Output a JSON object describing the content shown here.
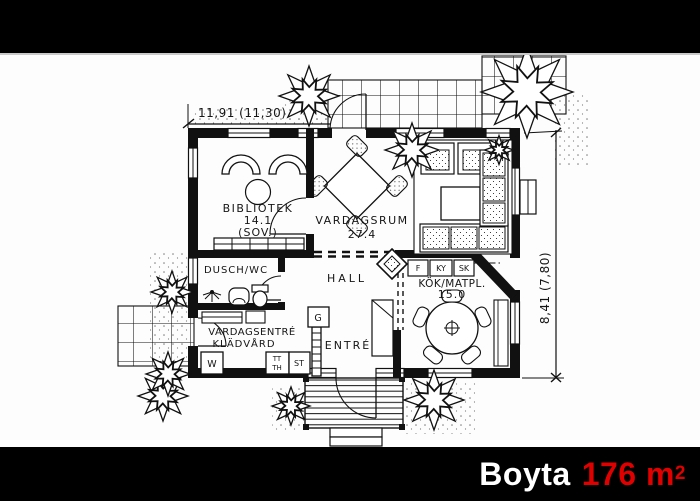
{
  "footer": {
    "label": "Boyta",
    "area_value": "176 m",
    "area_sup": "2",
    "accent_color": "#e00000"
  },
  "plan": {
    "dimensions": {
      "width_label": "11,91 (11,30)",
      "height_label": "8,41 (7,80)"
    },
    "rooms": {
      "bibliotek": {
        "name": "BIBLIOTEK",
        "area": "14.1",
        "alt": "(SOV.)"
      },
      "vardagsrum": {
        "name": "VARDAGSRUM",
        "area": "27.4"
      },
      "dusch": {
        "name": "DUSCH/WC"
      },
      "hall": {
        "name": "HALL"
      },
      "kok": {
        "name": "KÖK/MATPL.",
        "area": "15.0"
      },
      "vardagsentre": {
        "name_line1": "VARDAGSENTRÉ",
        "name_line2": "KLÄDVÅRD"
      },
      "entre": {
        "name": "ENTRÉ"
      }
    },
    "fixtures": {
      "g": "G",
      "st": "ST",
      "w": "W",
      "tt": "TT",
      "th": "TH",
      "f": "F",
      "ky": "KY",
      "sk": "SK"
    }
  }
}
